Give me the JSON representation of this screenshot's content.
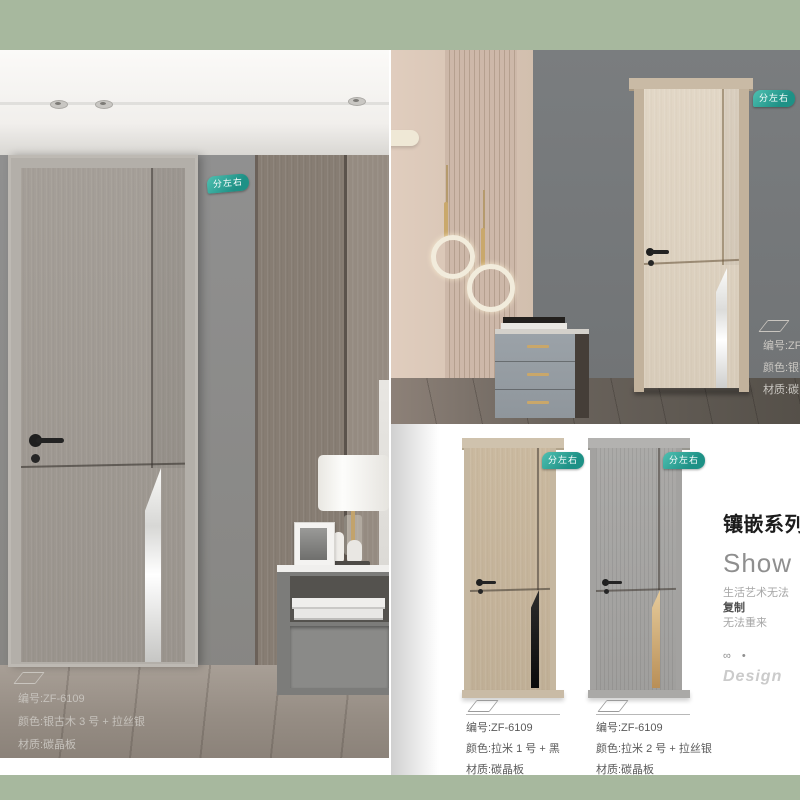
{
  "theme": {
    "sage_strip_color": "#a7b89e",
    "badge_teal_start": "#4fc0b1",
    "badge_teal_end": "#1e9186",
    "silver_inlay": "#e0e0de",
    "black_inlay": "#111111",
    "gold_inlay": "#c9a76a"
  },
  "scene_left": {
    "badge_label": "分左右",
    "info": {
      "code_line": "编号:ZF-6109",
      "color_line": "颜色:银古木 3 号 + 拉丝银",
      "material_line": "材质:碳晶板"
    }
  },
  "scene_top_right": {
    "badge_label": "分左右",
    "info": {
      "code_line": "编号:ZF-6",
      "color_line": "颜色:银古",
      "material_line": "材质:碳晶"
    }
  },
  "products": [
    {
      "badge_label": "分左右",
      "code_line": "编号:ZF-6109",
      "color_line": "颜色:拉米 1 号 + 黑",
      "material_line": "材质:碳晶板"
    },
    {
      "badge_label": "分左右",
      "code_line": "编号:ZF-6109",
      "color_line": "颜色:拉米 2 号 + 拉丝银",
      "material_line": "材质:碳晶板"
    }
  ],
  "series_panel": {
    "title": "镶嵌系列",
    "subtitle": "Show",
    "tagline_1": "生活艺术无法",
    "tagline_2": "复制",
    "tagline_3": "无法重来",
    "symbols": "∞ •",
    "design_label": "Design"
  }
}
